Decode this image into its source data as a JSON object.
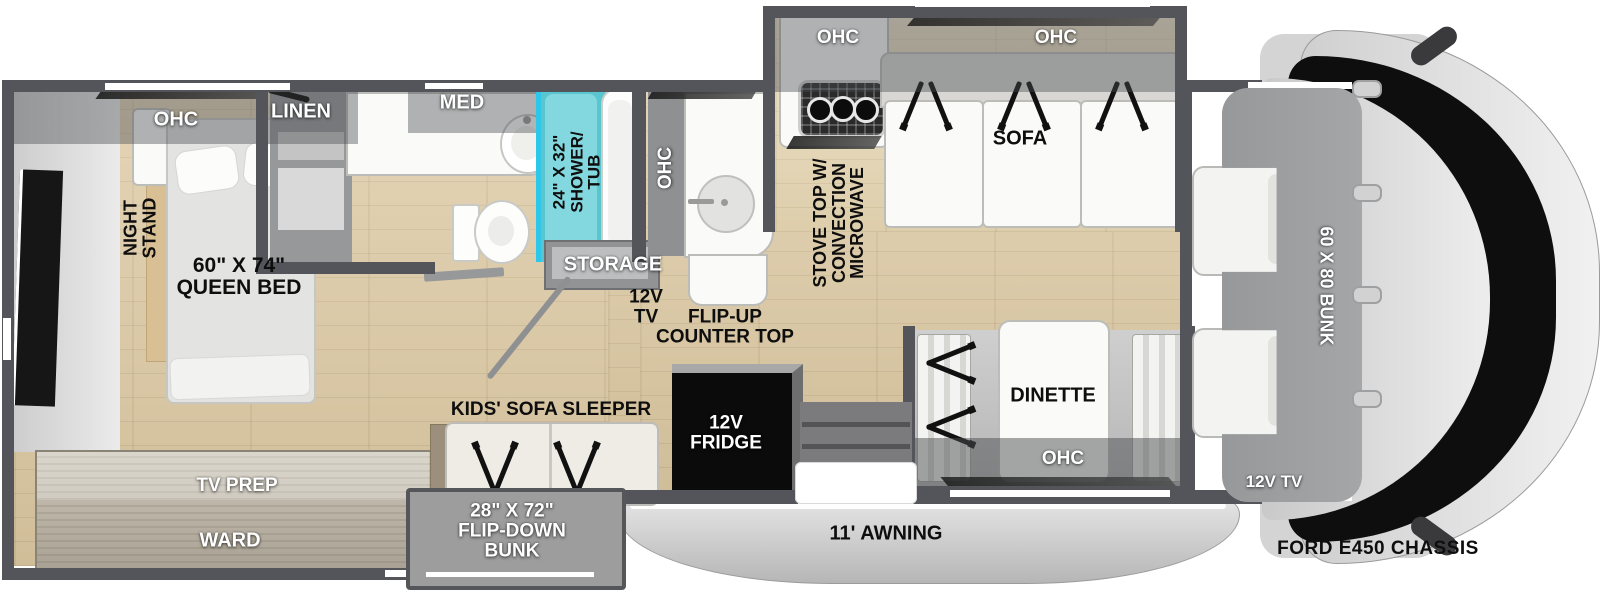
{
  "plan_title": "FORD E450 CHASSIS",
  "bedroom": {
    "ohc": "OHC",
    "night_stand_line1": "NIGHT",
    "night_stand_line2": "STAND",
    "bed_line1": "60\" X 74\"",
    "bed_line2": "QUEEN BED",
    "tv_prep": "TV PREP",
    "ward": "WARD"
  },
  "bathroom": {
    "linen": "LINEN",
    "med": "MED",
    "shower_line1": "24\" X 32\"",
    "shower_line2": "SHOWER/",
    "shower_line3": "TUB"
  },
  "hall": {
    "storage": "STORAGE",
    "tv_line1": "12V",
    "tv_line2": "TV",
    "counter_line1": "FLIP-UP",
    "counter_line2": "COUNTER TOP"
  },
  "kitchen": {
    "ohc_side": "OHC",
    "ohc_top": "OHC",
    "stove_line1": "STOVE TOP W/",
    "stove_line2": "CONVECTION",
    "stove_line3": "MICROWAVE"
  },
  "living": {
    "ohc": "OHC",
    "sofa": "SOFA",
    "kids_sofa": "KIDS' SOFA SLEEPER",
    "fridge_line1": "12V",
    "fridge_line2": "FRIDGE",
    "flip_bunk_line1": "28\" X 72\"",
    "flip_bunk_line2": "FLIP-DOWN",
    "flip_bunk_line3": "BUNK"
  },
  "dinette": {
    "label": "DINETTE",
    "ohc": "OHC"
  },
  "cab": {
    "bunk": "60 X 80 BUNK",
    "tv": "12V TV",
    "chassis": "FORD E450 CHASSIS"
  },
  "exterior": {
    "awning": "11' AWNING"
  },
  "colors": {
    "wall": "#54555a",
    "floor": "#ddc9a2",
    "shower_teal": "#58c5cf",
    "shower_glass": "#2ec7ea",
    "fridge_black": "#0b0b0b",
    "cab_gray": "#d8d8d8",
    "bunk_gray": "#9c9ea0"
  }
}
